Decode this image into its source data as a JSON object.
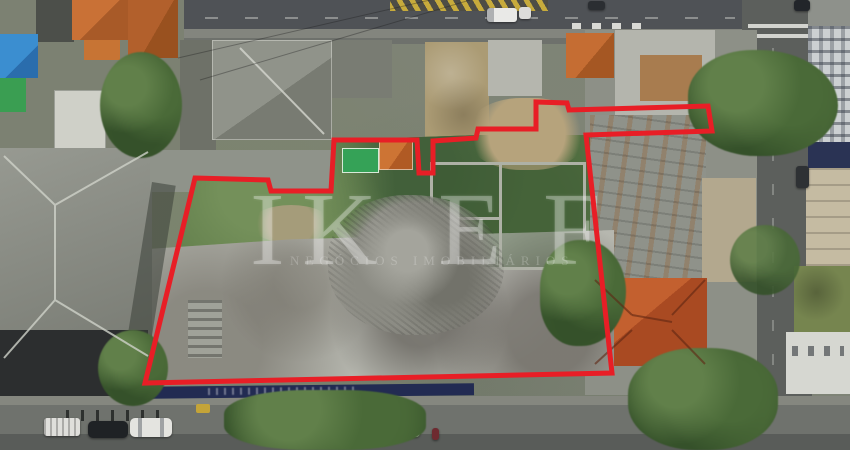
{
  "meta": {
    "type": "aerial-drone-photo",
    "description": "Aerial drone photograph of a city block with a large vacant demolition lot outlined by a thick red property-boundary line; real-estate listing image with translucent watermark."
  },
  "palette": {
    "boundary_red": "#e81e26",
    "roof_terracotta": "#b5542c",
    "roof_orange": "#c4682f",
    "vegetation_green": "#5c7847",
    "concrete_slab": "#b6b7af",
    "asphalt_dark": "#4f5256",
    "fence_navy": "#222b52",
    "house_green": "#35a257",
    "house_blue": "#3b8ed0",
    "tree_green": "#456334",
    "yellow_road_marking": "#c7ab3c"
  },
  "watermark": {
    "letters": [
      "I",
      "K",
      "E",
      "F"
    ],
    "subtitle": "NEGÓCIOS IMOBILIÁRIOS",
    "opacity": 0.3
  },
  "boundary": {
    "points": "195,178 268,180 271,191 331,191 334,140 417,140 419,173 433,173 433,141 476,138 478,129 536,129 536,102 567,103 569,110 708,106 712,131 586,135 612,373 145,383",
    "stroke_width": 5,
    "closed": true
  },
  "scene": {
    "features": [
      "avenue along top edge with yellow chevron zone, white box truck, white van and dark cars",
      "tiled-roof houses and blue/green houses at top left",
      "large gray warehouse hip roof on the left with dark street facade",
      "vacant lot: overgrown vegetation, roofless ruined walls, rubble pile and stained concrete slab",
      "red boundary polygon with notches around neighbouring houses",
      "terracotta hip roof and rusty sheds on the lower right block",
      "right-side street with zebra crosswalk, parked cars and large tree canopies",
      "apartment tower and beige buildings along the far right edge",
      "bottom street with parked cars, curb posts and navy hoarding with graffiti"
    ]
  },
  "vehicles": [
    {
      "name": "box-truck",
      "color": "white"
    },
    {
      "name": "van",
      "color": "white"
    },
    {
      "name": "car",
      "color": "dark"
    },
    {
      "name": "car",
      "color": "dark"
    },
    {
      "name": "car",
      "color": "blue"
    },
    {
      "name": "car",
      "color": "black"
    },
    {
      "name": "suv",
      "color": "white"
    },
    {
      "name": "suv",
      "color": "white"
    },
    {
      "name": "car",
      "color": "white"
    },
    {
      "name": "utility-cart",
      "color": "white"
    },
    {
      "name": "motorcycle",
      "color": "maroon"
    }
  ]
}
